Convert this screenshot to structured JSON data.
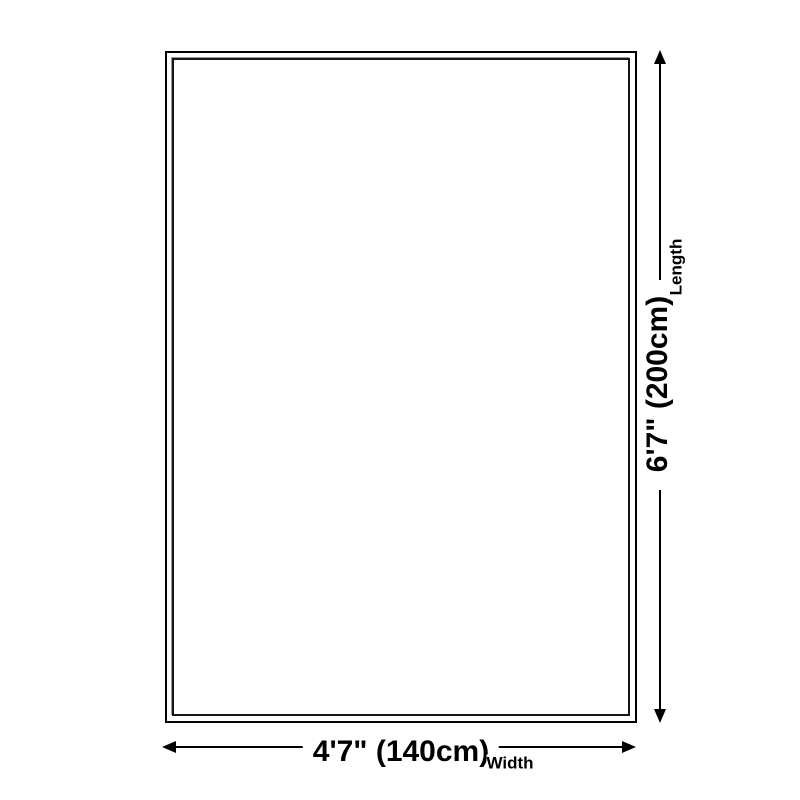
{
  "diagram": {
    "type": "product-size-diagram",
    "shape": "rectangle",
    "background_color": "#ffffff",
    "outline_color": "#000000",
    "line_color": "#000000",
    "text_color": "#000000",
    "length": {
      "value": "6'7\" (200cm)",
      "label": "Length"
    },
    "width": {
      "value": "4'7\" (140cm)",
      "label": "Width"
    },
    "icons": {
      "up": "arrow-up-icon",
      "down": "arrow-down-icon",
      "left": "arrow-left-icon",
      "right": "arrow-right-icon"
    }
  }
}
